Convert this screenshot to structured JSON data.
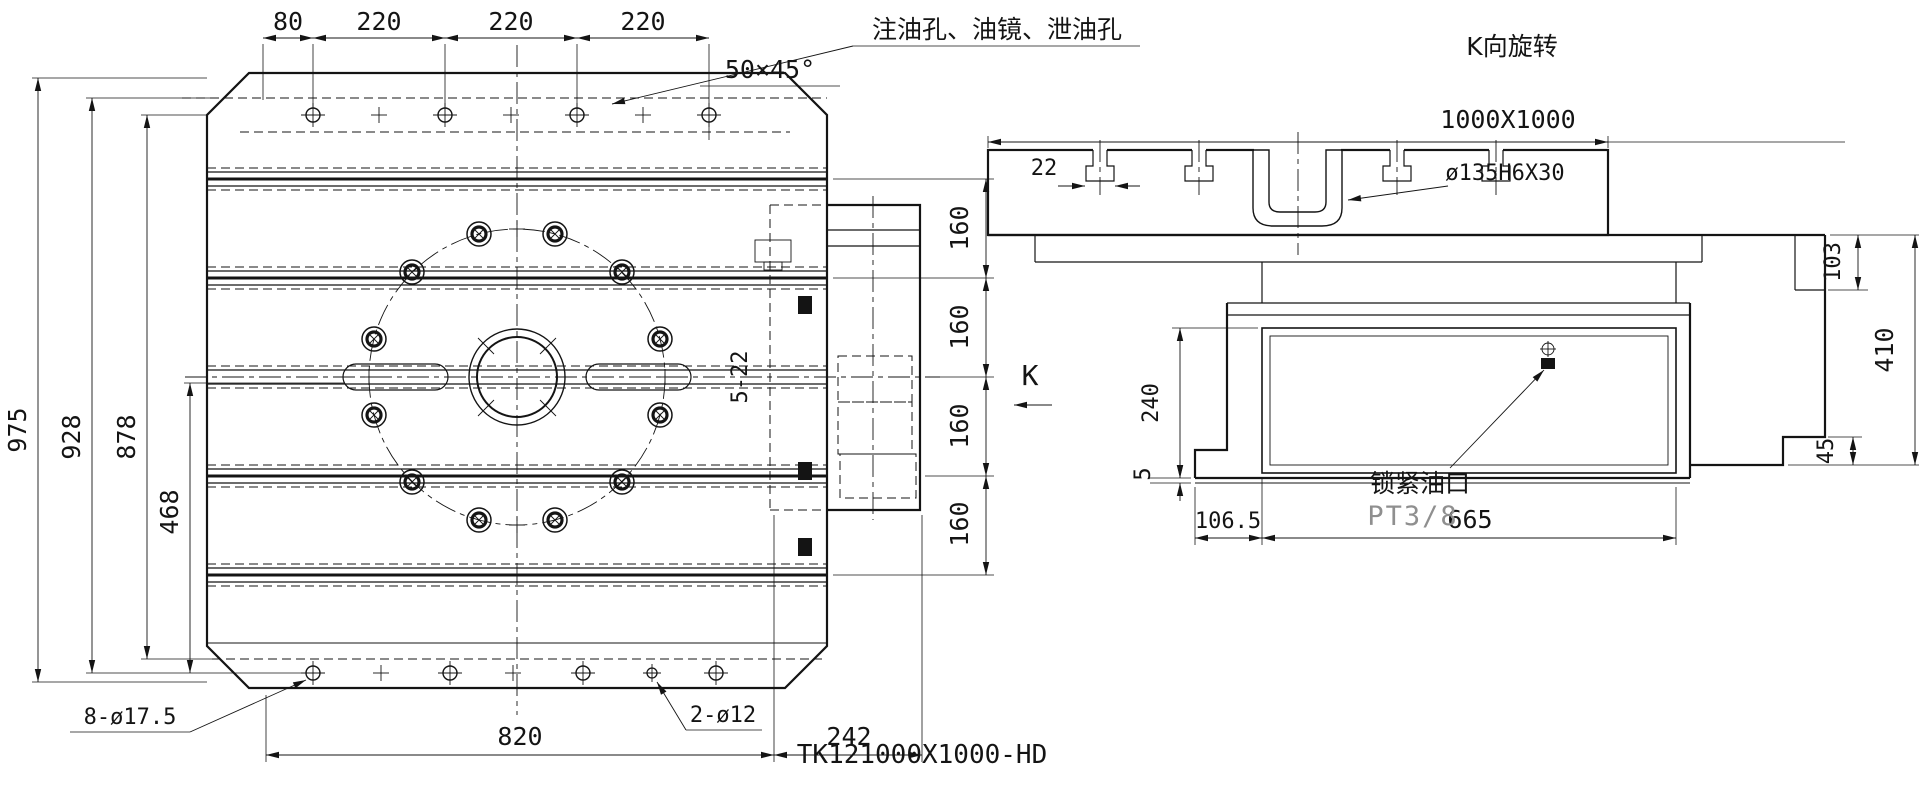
{
  "drawing": {
    "title": "TK121000X1000-HD",
    "left_view": {
      "top_dims": [
        "80",
        "220",
        "220",
        "220"
      ],
      "left_dims": [
        "975",
        "928",
        "878",
        "468"
      ],
      "right_dims": [
        "160",
        "160",
        "160",
        "160"
      ],
      "bottom_dims": [
        "820",
        "242"
      ],
      "labels": {
        "oil_holes": "注油孔、油镜、泄油孔",
        "chamfer": "50×45°",
        "holes_8": "8-ø17.5",
        "holes_2": "2-ø12",
        "slot_label": "5-22",
        "view_arrow": "K"
      }
    },
    "right_view": {
      "view_title": "K向旋转",
      "table_size": "1000X1000",
      "bore": "ø135H6X30",
      "slot_width": "22",
      "dims": {
        "d103": "103",
        "d410": "410",
        "d45": "45",
        "d240": "240",
        "d5": "5",
        "d106_5": "106.5",
        "d665": "665"
      },
      "labels": {
        "lock_port": "锁紧油口",
        "thread": "PT3/8"
      }
    },
    "colors": {
      "line": "#141414",
      "background": "#ffffff",
      "muted": "#8f8f8f"
    }
  }
}
